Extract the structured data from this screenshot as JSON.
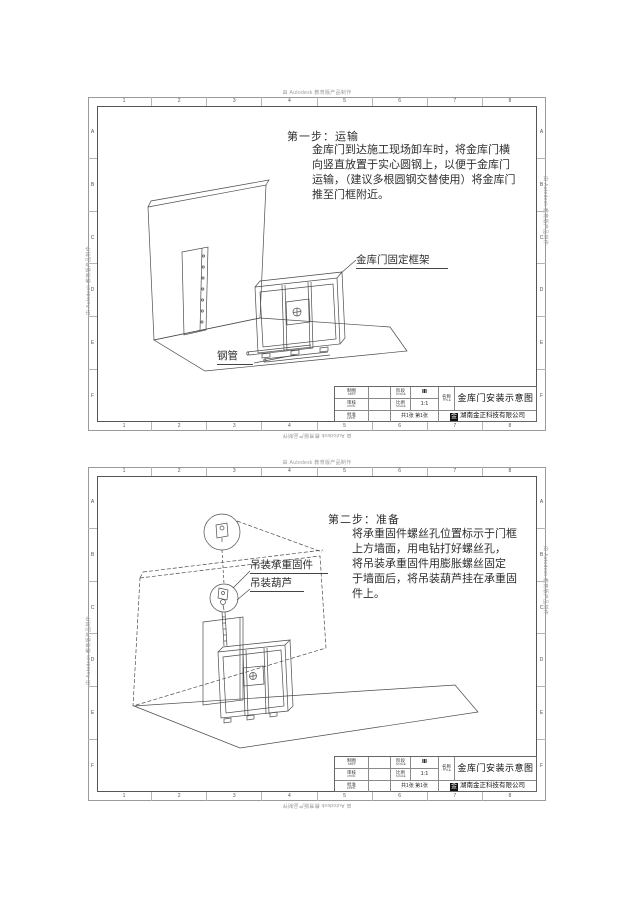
{
  "watermark": "由 Autodesk 教育版产品制作",
  "zones": {
    "cols": [
      "1",
      "2",
      "3",
      "4",
      "5",
      "6",
      "7",
      "8"
    ],
    "rows": [
      "A",
      "B",
      "C",
      "D",
      "E",
      "F"
    ]
  },
  "sheet1": {
    "step_title": "第一步：运输",
    "step_lines": [
      "金库门到达施工现场卸车时，将金库门横",
      "向竖直放置于实心圆钢上，以便于金库门",
      "运输，（建议多根圆钢交替使用）将金库门",
      "推至门框附近。"
    ],
    "labels": {
      "frame": "金库门固定框架",
      "pipe": "钢管"
    }
  },
  "sheet2": {
    "step_title": "第二步：准备",
    "step_lines": [
      "将承重固件螺丝孔位置标示于门框",
      "上方墙面，用电钻打好螺丝孔，",
      "将吊装承重固件用膨胀螺丝固定",
      "于墙面后，将吊装葫芦挂在承重固",
      "件上。"
    ],
    "labels": {
      "fixture": "吊装承重固件",
      "hoist": "吊装葫芦"
    }
  },
  "title_block": {
    "row1_label_cn": "制图",
    "row1_label_en": "DRFT.",
    "row2_label_cn": "审核",
    "row2_label_en": "CHKD.",
    "row3_label_cn": "批准",
    "row3_label_en": "APPD.",
    "stage_label_cn": "阶段",
    "stage_label_en": "STAGE",
    "stage_value": "Ⅲ",
    "scale_label_cn": "比例",
    "scale_label_en": "SCALE",
    "scale_value": "1:1",
    "sheets_text": "共1张 第1张",
    "name_label_cn": "名称",
    "name_label_en": "TITLE",
    "title": "金库门安装示意图",
    "company": "湖南金正科技有限公司",
    "logo_char": "金"
  }
}
